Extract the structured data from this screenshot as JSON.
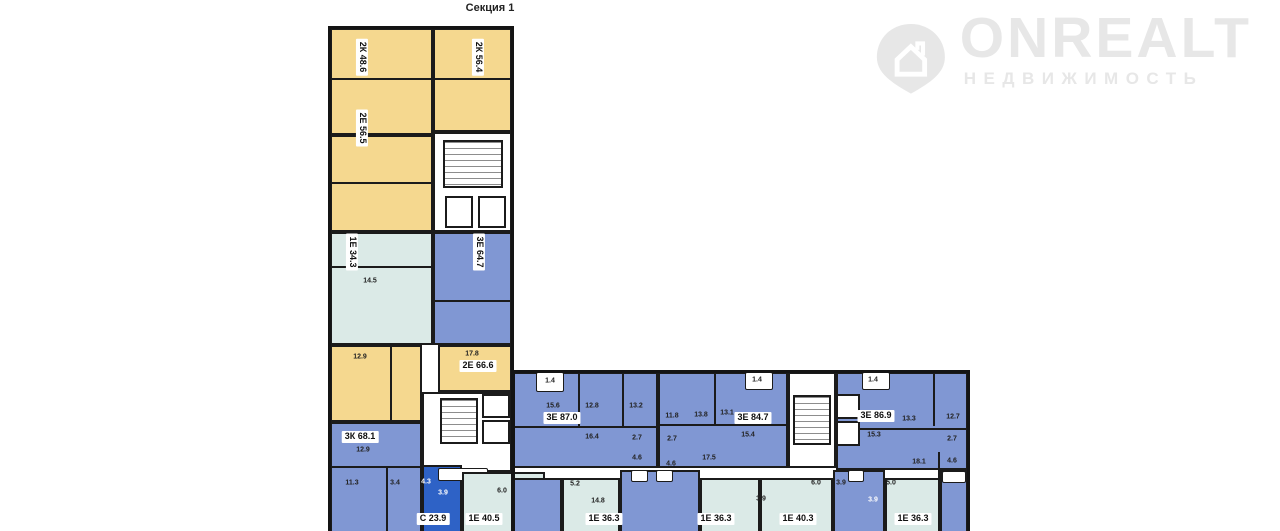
{
  "title": "Секция 1",
  "watermark": {
    "brand": "ONREALT",
    "subtitle": "НЕДВИЖИМОСТЬ",
    "icon": "house-pin-icon"
  },
  "colors": {
    "yellow_2room": "#f5d88f",
    "teal_1room": "#dbeae7",
    "blue_3room": "#8097d3",
    "dark_blue_studio": "#2e62c6",
    "wall": "#1b1b1b",
    "watermark_gray": "#e7e7e7"
  },
  "apartments": [
    {
      "label": "2К 48.6"
    },
    {
      "label": "2К 56.4"
    },
    {
      "label": "2Е 56.5"
    },
    {
      "label": "1Е 34.3"
    },
    {
      "label": "3Е 64.7"
    },
    {
      "label": "2Е 66.6"
    },
    {
      "label": "3К 68.1"
    },
    {
      "label": "С 23.9"
    },
    {
      "label": "1Е 40.5"
    },
    {
      "label": "3Е 87.0"
    },
    {
      "label": "1Е 36.3"
    },
    {
      "label": "3Е 84.7"
    },
    {
      "label": "1Е 36.3"
    },
    {
      "label": "3Е 86.9"
    },
    {
      "label": "1Е 40.3"
    },
    {
      "label": "1Е 36.3"
    }
  ],
  "room_areas": [
    "17.8",
    "12.9",
    "14.5",
    "12.9",
    "11.3",
    "3.4",
    "4.3",
    "3.9",
    "6.0",
    "1.4",
    "15.6",
    "12.8",
    "13.2",
    "16.4",
    "2.7",
    "4.6",
    "11.8",
    "2.7",
    "4.6",
    "13.8",
    "13.1",
    "15.4",
    "17.5",
    "1.4",
    "1.4",
    "13.3",
    "12.7",
    "15.3",
    "2.7",
    "18.1",
    "4.6",
    "5.2",
    "14.8",
    "3.9",
    "6.0",
    "3.9",
    "3.9",
    "5.0"
  ]
}
